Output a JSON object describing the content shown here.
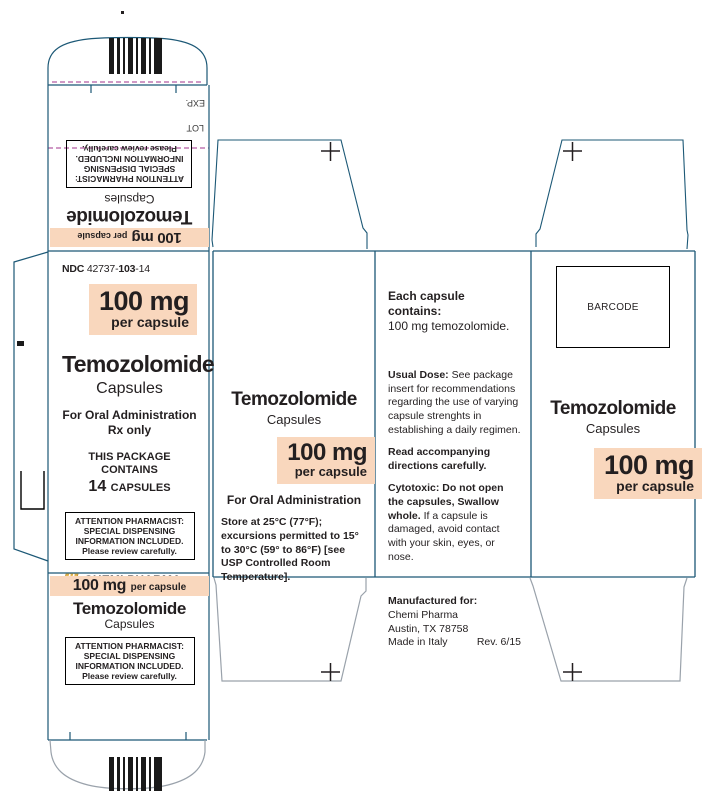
{
  "colors": {
    "outline": "#1c5876",
    "flap_outline": "#9aa2ab",
    "highlight": "#f9d7bd",
    "perforation": "#b55ca3",
    "text": "#231f20",
    "logo_gold": "#e8b64c"
  },
  "top_flap": {
    "exp": "EXP.",
    "lot": "LOT"
  },
  "inverted_panel": {
    "strength": "100 mg",
    "strength_unit": "per capsule",
    "brand": "Temozolomide",
    "form": "Capsules",
    "attention": [
      "ATTENTION PHARMACIST:",
      "SPECIAL DISPENSING",
      "INFORMATION INCLUDED.",
      "Please review carefully."
    ]
  },
  "main_panel": {
    "ndc_label": "NDC",
    "ndc_1": "42737-",
    "ndc_2": "103",
    "ndc_3": "-14",
    "strength": "100 mg",
    "strength_unit": "per capsule",
    "brand": "Temozolomide",
    "form": "Capsules",
    "admin": "For Oral Administration",
    "rx": "Rx only",
    "contains_line": "THIS PACKAGE CONTAINS",
    "count": "14",
    "count_unit": "CAPSULES",
    "attention": [
      "ATTENTION PHARMACIST:",
      "SPECIAL DISPENSING",
      "INFORMATION INCLUDED.",
      "Please review carefully."
    ],
    "logo": "CHEMI PHARMA"
  },
  "bottom_panel": {
    "strength": "100 mg",
    "strength_unit": "per capsule",
    "brand": "Temozolomide",
    "form": "Capsules",
    "attention": [
      "ATTENTION PHARMACIST:",
      "SPECIAL DISPENSING",
      "INFORMATION INCLUDED.",
      "Please review carefully."
    ]
  },
  "middle_panel": {
    "brand": "Temozolomide",
    "form": "Capsules",
    "strength": "100 mg",
    "strength_unit": "per capsule",
    "admin": "For Oral Administration",
    "storage": "Store at 25°C (77°F); excursions permitted to 15° to 30°C (59° to 86°F) [see USP Controlled Room Temperature]."
  },
  "info_panel": {
    "contains_title": "Each capsule contains:",
    "contains_value": "100 mg temozolomide.",
    "usual_dose_label": "Usual Dose:",
    "usual_dose_text": " See package insert for recommendations regarding the use of varying capsule strenghts in establishing a daily  regimen.",
    "read_note": "Read accompanying directions carefully.",
    "cytotoxic_label": "Cytotoxic: Do not open the capsules, Swallow whole.",
    "cytotoxic_text": " If a capsule is damaged, avoid contact with your skin, eyes, or nose.",
    "mfr_label": "Manufactured for:",
    "mfr_name": "Chemi Pharma",
    "mfr_city": "Austin, TX 78758",
    "mfr_origin": "Made in Italy",
    "rev": "Rev. 6/15"
  },
  "right_panel": {
    "barcode_label": "BARCODE",
    "brand": "Temozolomide",
    "form": "Capsules",
    "strength": "100 mg",
    "strength_unit": "per capsule"
  }
}
